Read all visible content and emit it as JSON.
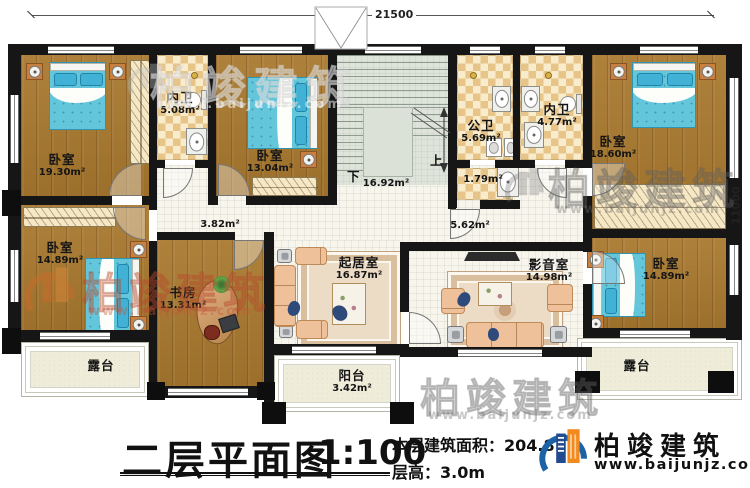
{
  "dimensions": {
    "width": "21500",
    "height": "11000"
  },
  "rooms": [
    {
      "id": "bedroom-tl",
      "name": "卧室",
      "area": "19.30m²"
    },
    {
      "id": "bath-tl",
      "name": "内卫",
      "area": "5.08m²"
    },
    {
      "id": "bedroom-t2",
      "name": "卧室",
      "area": "13.04m²"
    },
    {
      "id": "stairwell",
      "name": "",
      "area": "16.92m²"
    },
    {
      "id": "bath-public",
      "name": "公卫",
      "area": "5.69m²"
    },
    {
      "id": "bath-lobby",
      "name": "",
      "area": "1.79m²"
    },
    {
      "id": "bath-tr",
      "name": "内卫",
      "area": "4.77m²"
    },
    {
      "id": "bedroom-tr",
      "name": "卧室",
      "area": "18.60m²"
    },
    {
      "id": "hall-left",
      "name": "",
      "area": "3.82m²"
    },
    {
      "id": "hall-right",
      "name": "",
      "area": "5.62m²"
    },
    {
      "id": "bedroom-ml",
      "name": "卧室",
      "area": "14.89m²"
    },
    {
      "id": "study",
      "name": "书房",
      "area": "13.31m²"
    },
    {
      "id": "living",
      "name": "起居室",
      "area": "16.87m²"
    },
    {
      "id": "media",
      "name": "影音室",
      "area": "14.98m²"
    },
    {
      "id": "bedroom-br",
      "name": "卧室",
      "area": "14.89m²"
    },
    {
      "id": "terrace-left",
      "name": "露台",
      "area": ""
    },
    {
      "id": "balcony",
      "name": "阳台",
      "area": "3.42m²"
    },
    {
      "id": "terrace-right",
      "name": "露台",
      "area": ""
    }
  ],
  "stairs": {
    "up": "上",
    "down": "下"
  },
  "title": {
    "name": "二层平面图",
    "scale": "1:100",
    "area_label": "本层建筑面积：",
    "area_value": "204.8",
    "height_label": "层高：",
    "height_value": "3.0m"
  },
  "brand": {
    "name": "柏竣建筑",
    "url": "www.baijunjz.com"
  },
  "watermark": {
    "text": "柏竣建筑",
    "url": "www.baijunjz.com"
  }
}
